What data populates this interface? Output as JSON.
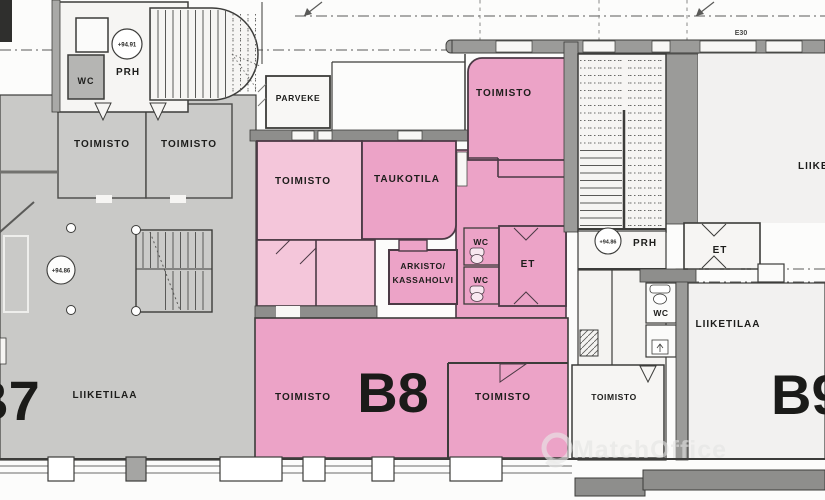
{
  "plan": {
    "annotations": {
      "e30": "E30",
      "watermark": "MatchOffice"
    },
    "elevations": {
      "top_left": "+94.91",
      "left": "+94.86",
      "right": "+94.86"
    },
    "units": {
      "b7": "B7",
      "b8": "B8",
      "b9": "B9"
    },
    "rooms": {
      "wc_top_left": "WC",
      "prh_left": "PRH",
      "toimisto_gray_1": "TOIMISTO",
      "toimisto_gray_2": "TOIMISTO",
      "parveke": "PARVEKE",
      "toimisto_pink_small": "TOIMISTO",
      "taukotila": "TAUKOTILA",
      "toimisto_top_right": "TOIMISTO",
      "arkisto_line1": "ARKISTO/",
      "arkisto_line2": "KASSAHOLVI",
      "wc_mid_top": "WC",
      "wc_mid_bottom": "WC",
      "et_mid": "ET",
      "prh_right": "PRH",
      "et_right": "ET",
      "wc_right": "WC",
      "liiketilaa_left": "LIIKETILAA",
      "liiketilaa_right": "LIIKETILAA",
      "liiketilaa_right_edge": "LIIKETILAA",
      "toimisto_b8_left": "TOIMISTO",
      "toimisto_b8_right": "TOIMISTO",
      "toimisto_bottom": "TOIMISTO"
    },
    "colors": {
      "pink_dark": "#eca3c7",
      "pink_light": "#f4c6da",
      "gray_area": "#c9c9c7",
      "wall_gray": "#9b9b99",
      "line": "#3c3c3a"
    }
  }
}
